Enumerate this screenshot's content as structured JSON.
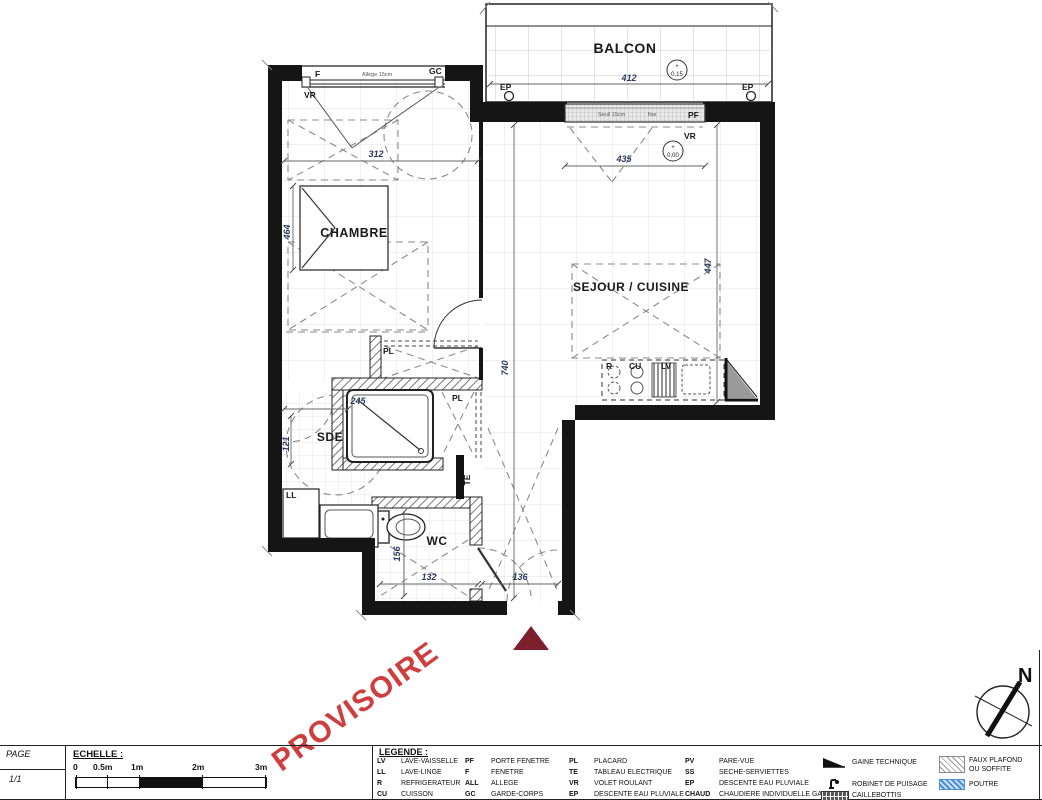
{
  "plan": {
    "rooms": {
      "balcon": "BALCON",
      "chambre": "CHAMBRE",
      "sejour": "SEJOUR / CUISINE",
      "sde": "SDE",
      "wc": "WC"
    },
    "levels": {
      "plus": "+",
      "balcony": "0,15",
      "interior": "0,00"
    },
    "dims": {
      "balcony_width": "412",
      "bay_width": "435",
      "chambre_width": "312",
      "chambre_depth": "464",
      "sde_width": "245",
      "sde_depth": "121",
      "hall_length": "740",
      "sejour_depth": "447",
      "wc_width": "132",
      "entry_width": "136",
      "wc_depth": "156"
    },
    "labels": {
      "ep": "EP",
      "pf": "PF",
      "vr": "VR",
      "f": "F",
      "gc": "GC",
      "allege": "Allège 15cm",
      "seuil": "Seuil 15cm",
      "fixe": "fixe",
      "pl": "PL",
      "te": "TE",
      "ll": "LL",
      "r": "R",
      "cu": "CU",
      "lv": "LV"
    },
    "north": "N"
  },
  "titleblock": {
    "page_label": "PAGE",
    "page_value": "1/1",
    "scale_label": "ECHELLE :",
    "scale_ticks": [
      "0",
      "0.5m",
      "1m",
      "2m",
      "3m"
    ],
    "watermark": "PROVISOIRE"
  },
  "legend": {
    "title": "LEGENDE :",
    "columns": [
      [
        {
          "abbr": "LV",
          "label": "LAVE-VAISSELLE"
        },
        {
          "abbr": "LL",
          "label": "LAVE-LINGE"
        },
        {
          "abbr": "R",
          "label": "REFRIGERATEUR"
        },
        {
          "abbr": "CU",
          "label": "CUISSON"
        }
      ],
      [
        {
          "abbr": "PF",
          "label": "PORTE FENETRE"
        },
        {
          "abbr": "F",
          "label": "FENETRE"
        },
        {
          "abbr": "ALL",
          "label": "ALLEGE"
        },
        {
          "abbr": "GC",
          "label": "GARDE-CORPS"
        }
      ],
      [
        {
          "abbr": "PL",
          "label": "PLACARD"
        },
        {
          "abbr": "TE",
          "label": "TABLEAU ELECTRIQUE"
        },
        {
          "abbr": "VR",
          "label": "VOLET ROULANT"
        },
        {
          "abbr": "EP",
          "label": "DESCENTE EAU PLUVIALE"
        }
      ],
      [
        {
          "abbr": "PV",
          "label": "PARE-VUE"
        },
        {
          "abbr": "SS",
          "label": "SECHE-SERVIETTES"
        },
        {
          "abbr": "EP",
          "label": "DESCENTE EAU PLUVIALE"
        },
        {
          "abbr": "CHAUD",
          "label": "CHAUDIERE INDIVIDUELLE GAZ"
        }
      ]
    ],
    "symbols": {
      "gaine": {
        "icon": "gaine-technique-icon",
        "label": "GAINE TECHNIQUE"
      },
      "robinet": {
        "icon": "robinet-de-puisage-icon",
        "label": "ROBINET DE PUISAGE"
      },
      "caillebottis": {
        "icon": "caillebottis-icon",
        "label": "CAILLEBOTTIS"
      },
      "faux_plafond": {
        "icon": "faux-plafond-icon",
        "label": "FAUX PLAFOND",
        "label2": "OU SOFFITE"
      },
      "poutre": {
        "icon": "poutre-icon",
        "label": "POUTRE"
      }
    }
  },
  "colors": {
    "watermark_red": "#cf3e3e",
    "entry_marker_maroon": "#7d1f2d",
    "poutre_blue": "#4a90d9",
    "wall_black": "#151515"
  }
}
